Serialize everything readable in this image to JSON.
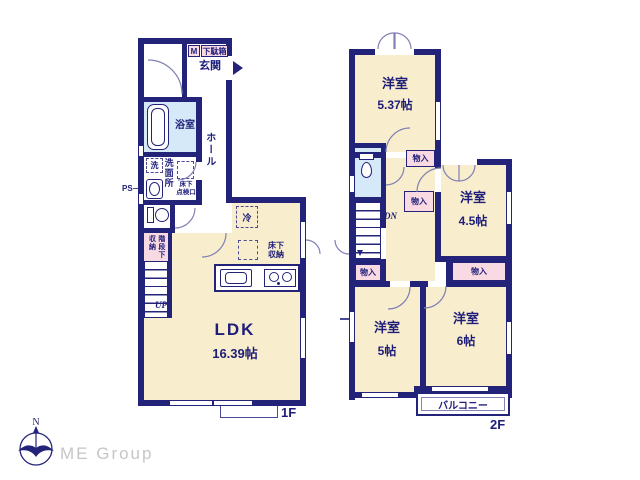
{
  "watermark": {
    "brand": "ME Group"
  },
  "compass": {
    "north_label": "N"
  },
  "colors": {
    "wall": "#232379",
    "room": "#f8edcc",
    "closet": "#f9dae2",
    "wet_area": "#d6e9f8",
    "text": "#1e1e7a"
  },
  "floor1": {
    "floor_label": "1F",
    "entrance_label": "玄関",
    "shoebox_m_label": "M",
    "shoebox_label": "下駄箱",
    "bathroom_label": "浴室",
    "washer_label": "洗",
    "washroom_label": "洗面所",
    "floor_hatch_label": "床下\n点検口",
    "ps_label": "PS",
    "hall_label": "ホール",
    "understair_storage_label": "階段下\n収納",
    "up_label": "UP",
    "fridge_label": "冷",
    "underfloor_storage_label": "床下\n収納",
    "ldk_label": "LDK",
    "ldk_size": "16.39帖"
  },
  "floor2": {
    "floor_label": "2F",
    "closet_label": "物入",
    "dn_label": "DN",
    "balcony_label": "バルコニー",
    "room_537": {
      "name": "洋室",
      "size": "5.37帖"
    },
    "room_45": {
      "name": "洋室",
      "size": "4.5帖"
    },
    "room_5": {
      "name": "洋室",
      "size": "5帖"
    },
    "room_6": {
      "name": "洋室",
      "size": "6帖"
    }
  }
}
